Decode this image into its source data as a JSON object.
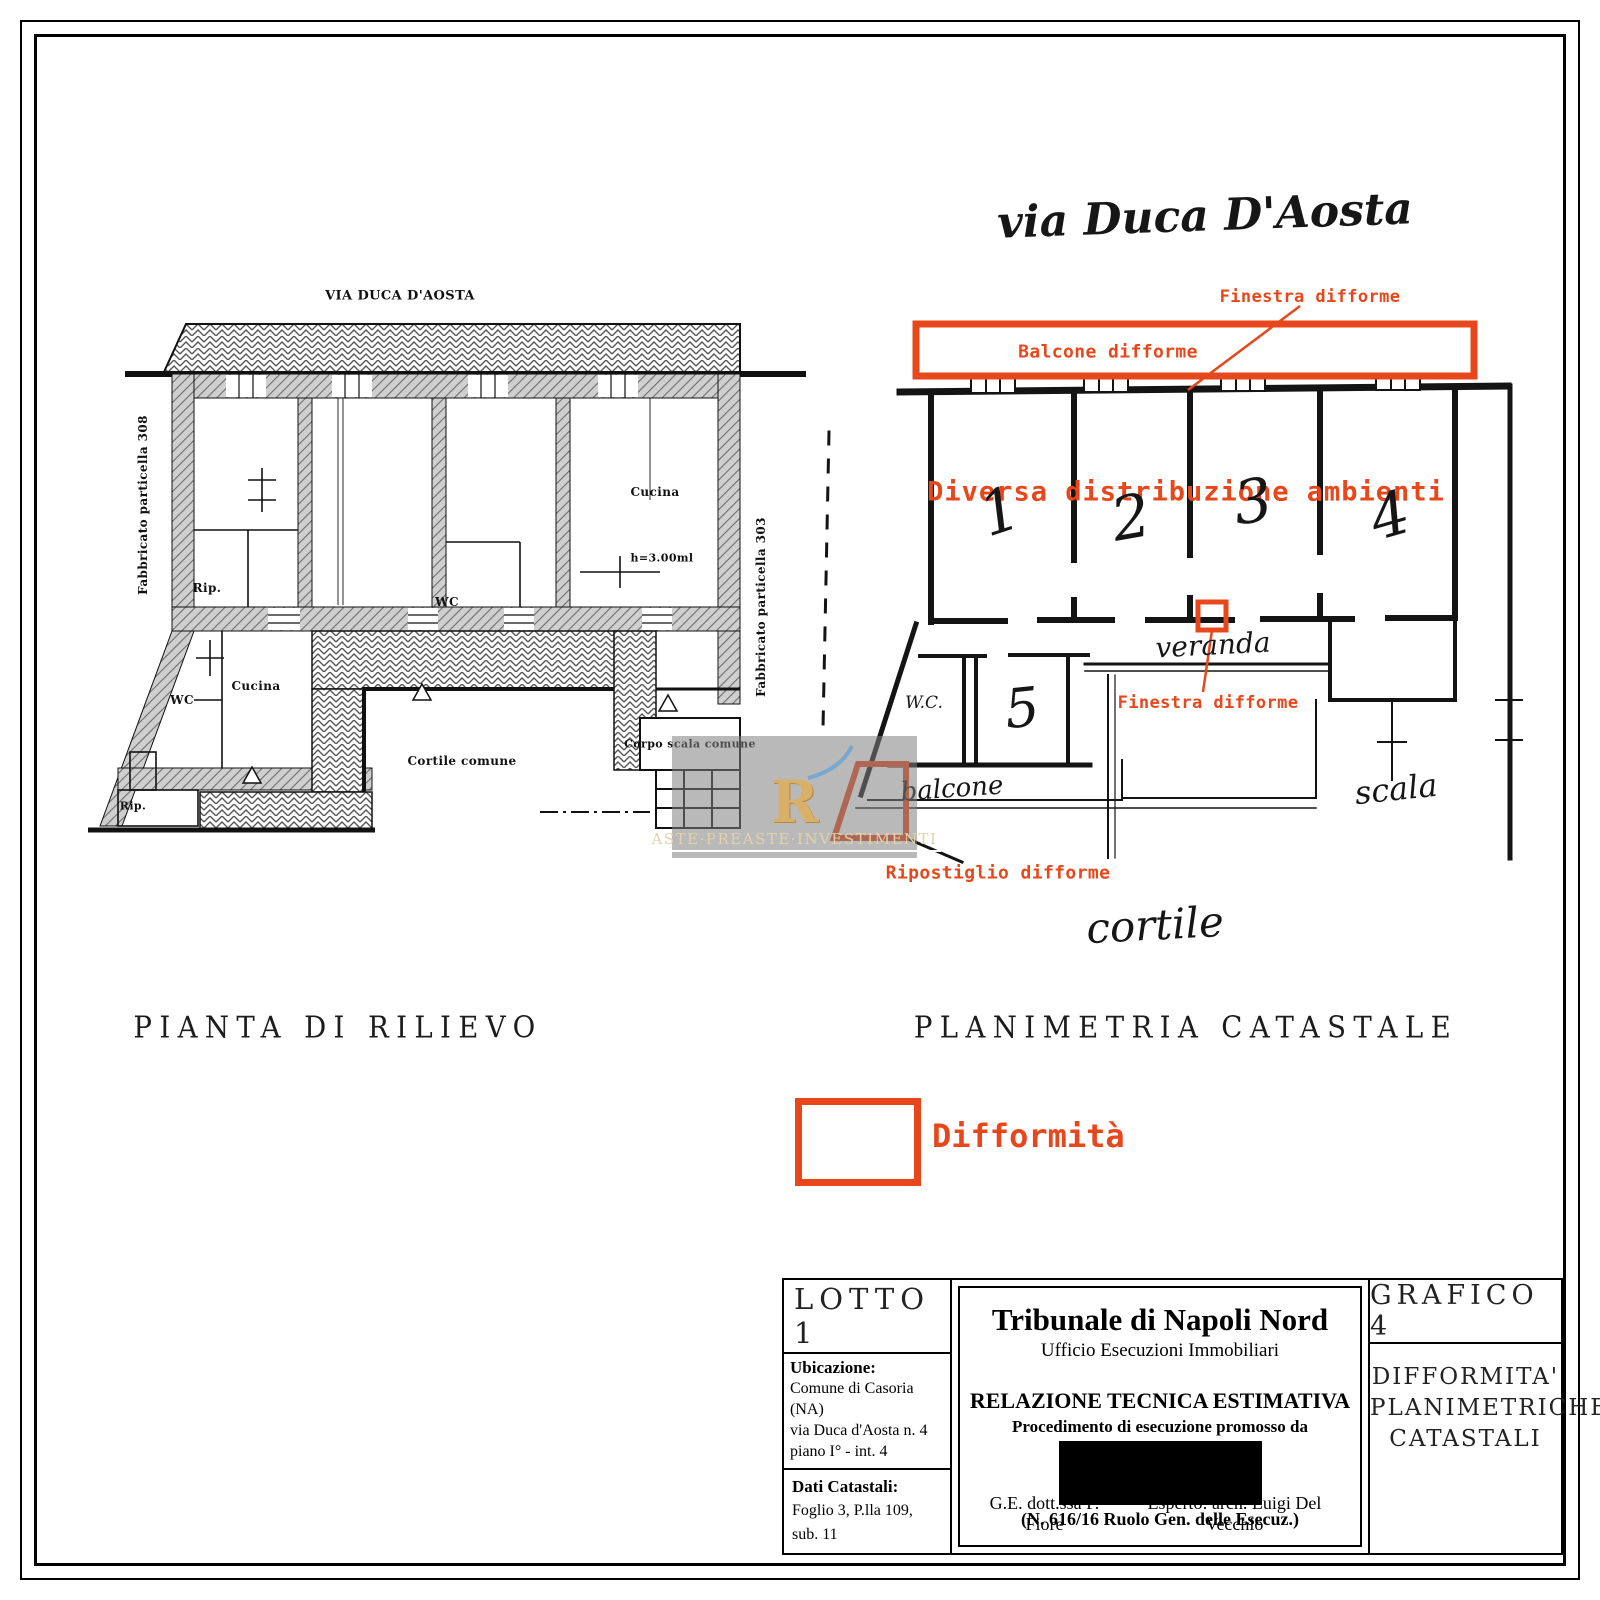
{
  "colors": {
    "annotation_red": "#e8471b",
    "wall_gray": "#cfcfcf",
    "hatch_line": "#6e6e6e",
    "watermark_gold": "#d8b06a"
  },
  "left_plan": {
    "title": "PIANTA DI RILIEVO",
    "street_label": "VIA DUCA D'AOSTA",
    "side_label_left": "Fabbricato particella 308",
    "side_label_right": "Fabbricato particella 303",
    "rooms": {
      "rip_upper": "Rip.",
      "wc_upper": "WC",
      "cucina_upper": "Cucina",
      "height_note": "h=3.00ml",
      "wc_lower": "WC",
      "cucina_lower": "Cucina",
      "rip_lower": "Rip.",
      "cortile": "Cortile comune",
      "corpo_scala": "Corpo scala comune"
    }
  },
  "right_plan": {
    "title": "PLANIMETRIA CATASTALE",
    "street_label": "via Duca D'Aosta",
    "annotations": {
      "finestra_top": "Finestra difforme",
      "balcone_box": "Balcone difforme",
      "diversa": "Diversa distribuzione ambienti",
      "finestra_mid": "Finestra difforme",
      "ripostiglio": "Ripostiglio difforme"
    },
    "handwritten": {
      "room_numbers": [
        "1",
        "2",
        "3",
        "4",
        "5"
      ],
      "wc": "W.C.",
      "veranda": "veranda",
      "balcone": "balcone",
      "scala": "scala",
      "cortile": "cortile"
    }
  },
  "legend": {
    "label": "Difformità"
  },
  "watermark": {
    "logo_text": "R",
    "text": "ASTE·PREASTE·INVESTIMENTI"
  },
  "title_block": {
    "lotto": "LOTTO 1",
    "ubicazione_label": "Ubicazione:",
    "ubicazione_lines": [
      "Comune di Casoria (NA)",
      "via Duca d'Aosta n. 4",
      "piano I° - int. 4"
    ],
    "dati_label": "Dati Catastali:",
    "dati_value": "Foglio 3, P.lla 109, sub. 11",
    "court": "Tribunale di Napoli Nord",
    "office": "Ufficio Esecuzioni Immobiliari",
    "report": "RELAZIONE TECNICA ESTIMATIVA",
    "proc": "Procedimento di esecuzione promosso da",
    "ruolo": "(N. 616/16 Ruolo Gen. delle Esecuz.)",
    "ge": "G.E. dott.ssa F. Fiore",
    "esperto": "Esperto: arch. Luigi Del Vecchio",
    "grafico": "GRAFICO 4",
    "grafico_desc_lines": [
      "DIFFORMITA'",
      "PLANIMETRICHE",
      "CATASTALI"
    ]
  }
}
